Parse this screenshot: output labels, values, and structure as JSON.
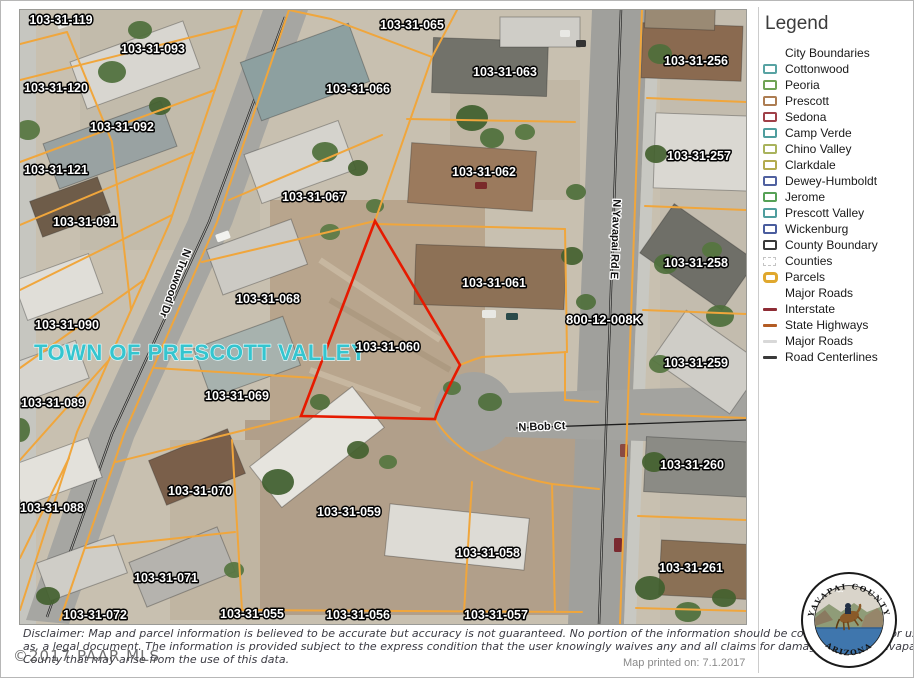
{
  "map": {
    "town_label": "TOWN OF PRESCOTT VALLEY",
    "highlighted_parcel": "103-31-060",
    "highlight_color": "#e61a00",
    "parcel_line_color": "#f0a63c",
    "parcel_labels": [
      {
        "t": "103-31-119",
        "x": 41,
        "y": 10
      },
      {
        "t": "103-31-093",
        "x": 133,
        "y": 39
      },
      {
        "t": "103-31-065",
        "x": 392,
        "y": 15
      },
      {
        "t": "103-31-063",
        "x": 485,
        "y": 62
      },
      {
        "t": "103-31-256",
        "x": 676,
        "y": 51
      },
      {
        "t": "103-31-120",
        "x": 36,
        "y": 78
      },
      {
        "t": "103-31-066",
        "x": 338,
        "y": 79
      },
      {
        "t": "103-31-092",
        "x": 102,
        "y": 117
      },
      {
        "t": "103-31-257",
        "x": 679,
        "y": 146
      },
      {
        "t": "103-31-121",
        "x": 36,
        "y": 160
      },
      {
        "t": "103-31-062",
        "x": 464,
        "y": 162
      },
      {
        "t": "103-31-067",
        "x": 294,
        "y": 187
      },
      {
        "t": "103-31-091",
        "x": 65,
        "y": 212
      },
      {
        "t": "103-31-258",
        "x": 676,
        "y": 253
      },
      {
        "t": "103-31-061",
        "x": 474,
        "y": 273
      },
      {
        "t": "103-31-068",
        "x": 248,
        "y": 289
      },
      {
        "t": "800-12-008K",
        "x": 584,
        "y": 310,
        "s": 13
      },
      {
        "t": "103-31-090",
        "x": 47,
        "y": 315
      },
      {
        "t": "103-31-060",
        "x": 368,
        "y": 337
      },
      {
        "t": "103-31-259",
        "x": 676,
        "y": 353
      },
      {
        "t": "103-31-069",
        "x": 217,
        "y": 386
      },
      {
        "t": "103-31-089",
        "x": 33,
        "y": 393
      },
      {
        "t": "103-31-260",
        "x": 672,
        "y": 455
      },
      {
        "t": "103-31-070",
        "x": 180,
        "y": 481
      },
      {
        "t": "103-31-088",
        "x": 32,
        "y": 498
      },
      {
        "t": "103-31-059",
        "x": 329,
        "y": 502
      },
      {
        "t": "103-31-058",
        "x": 468,
        "y": 543
      },
      {
        "t": "103-31-261",
        "x": 671,
        "y": 558
      },
      {
        "t": "103-31-071",
        "x": 146,
        "y": 568
      },
      {
        "t": "103-31-055",
        "x": 232,
        "y": 604
      },
      {
        "t": "103-31-056",
        "x": 338,
        "y": 605
      },
      {
        "t": "103-31-072",
        "x": 75,
        "y": 605
      },
      {
        "t": "103-31-057",
        "x": 476,
        "y": 605
      }
    ],
    "road_labels": [
      {
        "t": "N Truwood Dr",
        "x": 152,
        "y": 272,
        "r": 110
      },
      {
        "t": "N Yavapai Rd E",
        "x": 592,
        "y": 229,
        "r": 92
      },
      {
        "t": "N Bob Ct",
        "x": 522,
        "y": 420,
        "r": -2
      }
    ]
  },
  "legend": {
    "title": "Legend",
    "items": [
      {
        "label": "City Boundaries",
        "type": "none"
      },
      {
        "label": "Cottonwood",
        "type": "box",
        "color": "#58a3a3"
      },
      {
        "label": "Peoria",
        "type": "box",
        "color": "#6fa355"
      },
      {
        "label": "Prescott",
        "type": "box",
        "color": "#ad7d52"
      },
      {
        "label": "Sedona",
        "type": "box",
        "color": "#a04048"
      },
      {
        "label": "Camp Verde",
        "type": "box",
        "color": "#4f9e9e"
      },
      {
        "label": "Chino Valley",
        "type": "box",
        "color": "#a9b35c"
      },
      {
        "label": "Clarkdale",
        "type": "box",
        "color": "#b3ab4f"
      },
      {
        "label": "Dewey-Humboldt",
        "type": "box",
        "color": "#5061a0"
      },
      {
        "label": "Jerome",
        "type": "box",
        "color": "#56a156"
      },
      {
        "label": "Prescott Valley",
        "type": "box",
        "color": "#4f9e9e"
      },
      {
        "label": "Wickenburg",
        "type": "box",
        "color": "#4a5d9e"
      },
      {
        "label": "County Boundary",
        "type": "box",
        "color": "#3a3a3a"
      },
      {
        "label": "Counties",
        "type": "dash",
        "color": "#c9c9c9"
      },
      {
        "label": "Parcels",
        "type": "parcel",
        "color": "#e0a82e"
      },
      {
        "label": "Major Roads",
        "type": "none"
      },
      {
        "label": "Interstate",
        "type": "line",
        "color": "#8e2c35"
      },
      {
        "label": "State Highways",
        "type": "line",
        "color": "#b35c24"
      },
      {
        "label": "Major Roads",
        "type": "line",
        "color": "#d8d8d8"
      },
      {
        "label": "Road Centerlines",
        "type": "line",
        "color": "#3a3a3a"
      }
    ]
  },
  "footer": {
    "disclaimer_line1": "Disclaimer: Map and parcel information is believed to be accurate but accuracy is not guaranteed. No portion of the information should be considered to be, or used",
    "disclaimer_line2": "as, a legal document.  The information is provided subject to the express condition that the user knowingly waives any and all claims for damages against Yavapai",
    "disclaimer_line3": "County that may arise from the use of this data.",
    "copyright": "©2017 PAAR MLS",
    "printed": "Map printed on: 7.1.2017"
  },
  "seal": {
    "arc_top": "YAVAPAI  COUNTY",
    "arc_bottom": "ARIZONA"
  }
}
